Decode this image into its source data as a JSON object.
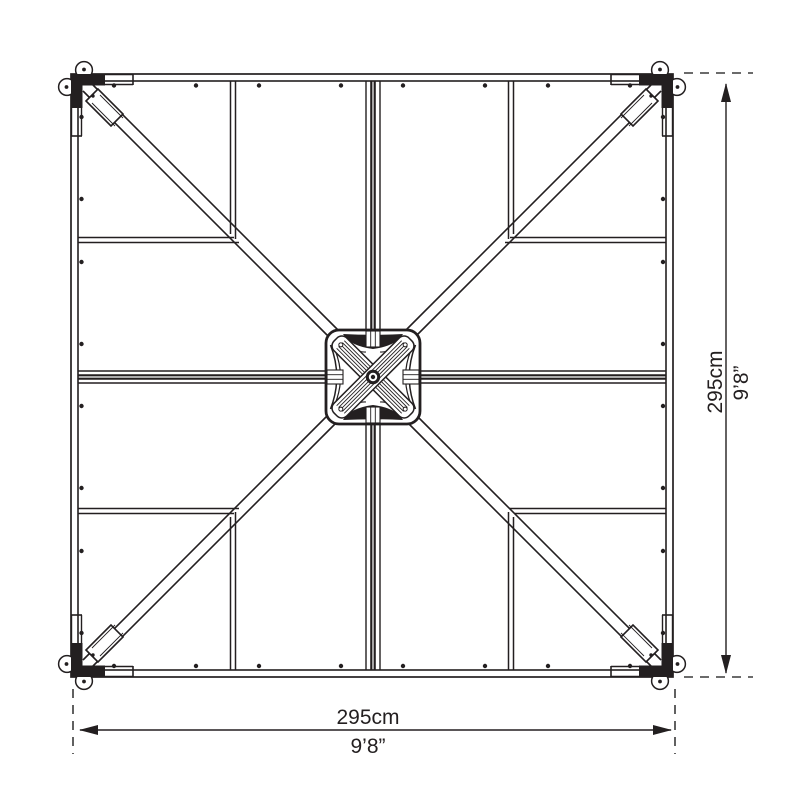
{
  "diagram": {
    "kind": "plan-view line drawing of a square roof frame with diagonal braces and central hub",
    "dimensions": {
      "bottom": {
        "metric": "295cm",
        "imperial": "9’8”"
      },
      "right": {
        "metric": "295cm",
        "imperial": "9’8”"
      }
    },
    "colors": {
      "line": "#231f20",
      "background": "#ffffff"
    }
  }
}
